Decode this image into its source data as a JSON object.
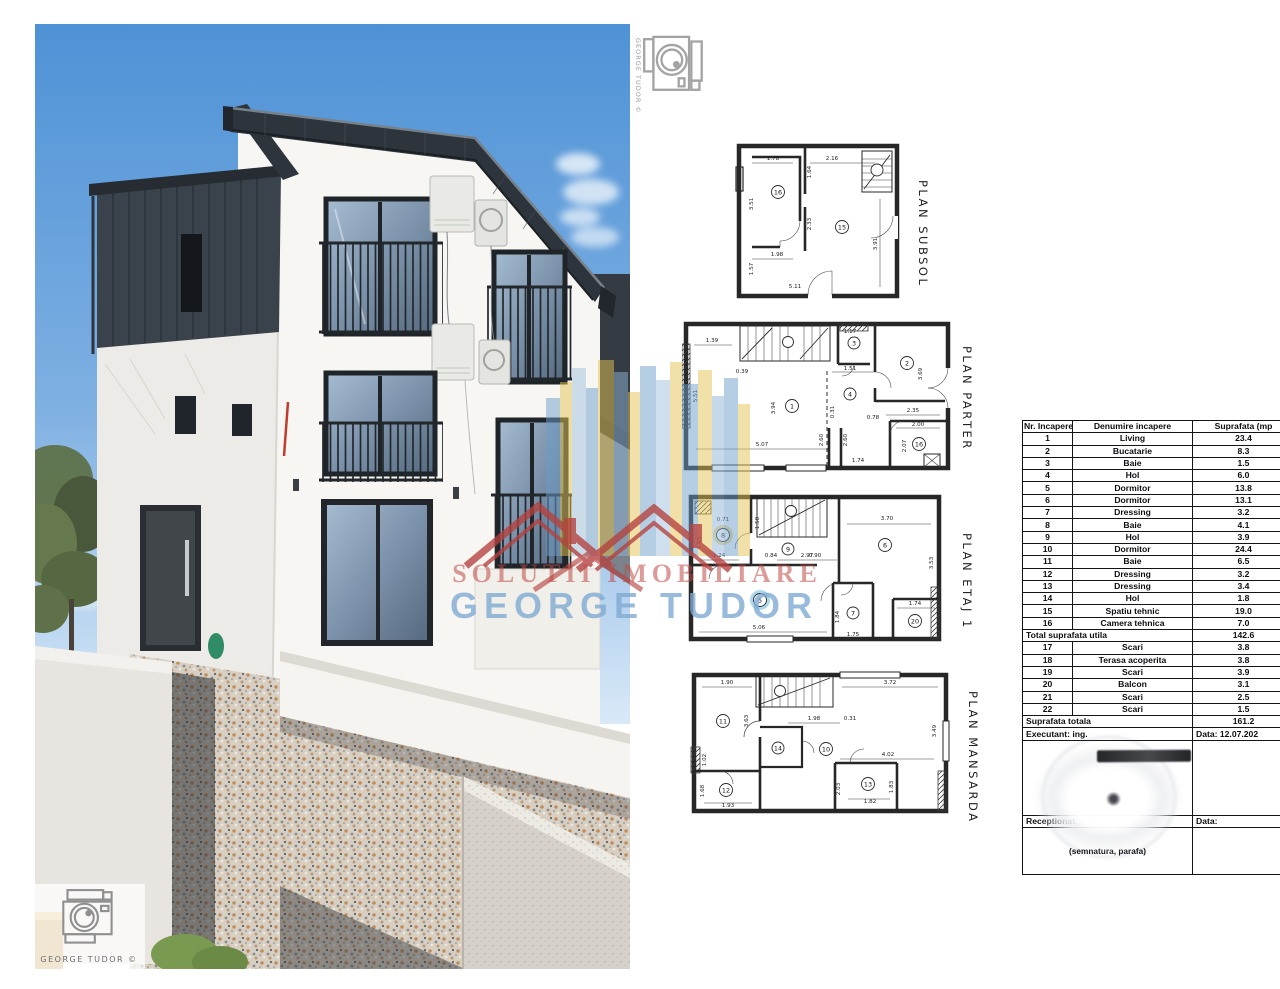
{
  "watermark": {
    "line1": "SOLUTII IMOBILIARE",
    "line2": "GEORGE TUDOR",
    "credit": "GEORGE TUDOR  ©",
    "colors": {
      "red": "#b5413e",
      "blue": "#7fa9d0",
      "yellow": "#e4c452",
      "steel": "#6f9ec9"
    }
  },
  "plans": {
    "subsol": {
      "title": "PLAN SUBSOL",
      "rooms": [
        "16",
        "15"
      ],
      "dims": [
        "1.78",
        "2.16",
        "1.64",
        "3.51",
        "2.33",
        "3.91",
        "1.98",
        "1.57",
        "5.11"
      ]
    },
    "parter": {
      "title": "PLAN PARTER",
      "rooms": [
        "1",
        "2",
        "3",
        "4",
        "16"
      ],
      "dims": [
        "1.39",
        "5.51",
        "0.39",
        "3.94",
        "5.07",
        "1.51",
        "1.17",
        "3.69",
        "2.35",
        "0.78",
        "2.00",
        "2.07",
        "1.74",
        "0.31",
        "2.60",
        "2.60"
      ]
    },
    "etaj1": {
      "title": "PLAN ETAJ 1",
      "rooms": [
        "8",
        "9",
        "6",
        "5",
        "7",
        "20"
      ],
      "dims": [
        "0.71",
        "1.63",
        "1.58",
        "0.84",
        "0.90",
        "1.24",
        "2.97",
        "3.70",
        "3.53",
        "1.84",
        "1.75",
        "5.06",
        "1.74"
      ]
    },
    "mansarda": {
      "title": "PLAN MANSARDA",
      "rooms": [
        "11",
        "14",
        "10",
        "12",
        "13"
      ],
      "dims": [
        "1.90",
        "3.72",
        "3.63",
        "3.49",
        "1.98",
        "0.31",
        "4.02",
        "2.03",
        "1.82",
        "1.83",
        "1.93",
        "1.68",
        "1.02"
      ]
    }
  },
  "table": {
    "headers": [
      "Nr. Incapere",
      "Denumire incapere",
      "Suprafata (mp"
    ],
    "rows": [
      [
        "1",
        "Living",
        "23.4"
      ],
      [
        "2",
        "Bucatarie",
        "8.3"
      ],
      [
        "3",
        "Baie",
        "1.5"
      ],
      [
        "4",
        "Hol",
        "6.0"
      ],
      [
        "5",
        "Dormitor",
        "13.8"
      ],
      [
        "6",
        "Dormitor",
        "13.1"
      ],
      [
        "7",
        "Dressing",
        "3.2"
      ],
      [
        "8",
        "Baie",
        "4.1"
      ],
      [
        "9",
        "Hol",
        "3.9"
      ],
      [
        "10",
        "Dormitor",
        "24.4"
      ],
      [
        "11",
        "Baie",
        "6.5"
      ],
      [
        "12",
        "Dressing",
        "3.2"
      ],
      [
        "13",
        "Dressing",
        "3.4"
      ],
      [
        "14",
        "Hol",
        "1.8"
      ],
      [
        "15",
        "Spatiu tehnic",
        "19.0"
      ],
      [
        "16",
        "Camera tehnica",
        "7.0"
      ]
    ],
    "total_utila": {
      "label": "Total suprafata utila",
      "value": "142.6"
    },
    "rows2": [
      [
        "17",
        "Scari",
        "3.8"
      ],
      [
        "18",
        "Terasa acoperita",
        "3.8"
      ],
      [
        "19",
        "Scari",
        "3.9"
      ],
      [
        "20",
        "Balcon",
        "3.1"
      ],
      [
        "21",
        "Scari",
        "2.5"
      ],
      [
        "22",
        "Scari",
        "1.5"
      ]
    ],
    "total": {
      "label": "Suprafata totala",
      "value": "161.2"
    },
    "executant": {
      "label": "Executant: ing.",
      "data_label": "Data: 12.07.202"
    },
    "receptionat": {
      "label": "Receptionat,",
      "data_label": "Data:"
    },
    "signature_note": "(semnatura, parafa)"
  }
}
